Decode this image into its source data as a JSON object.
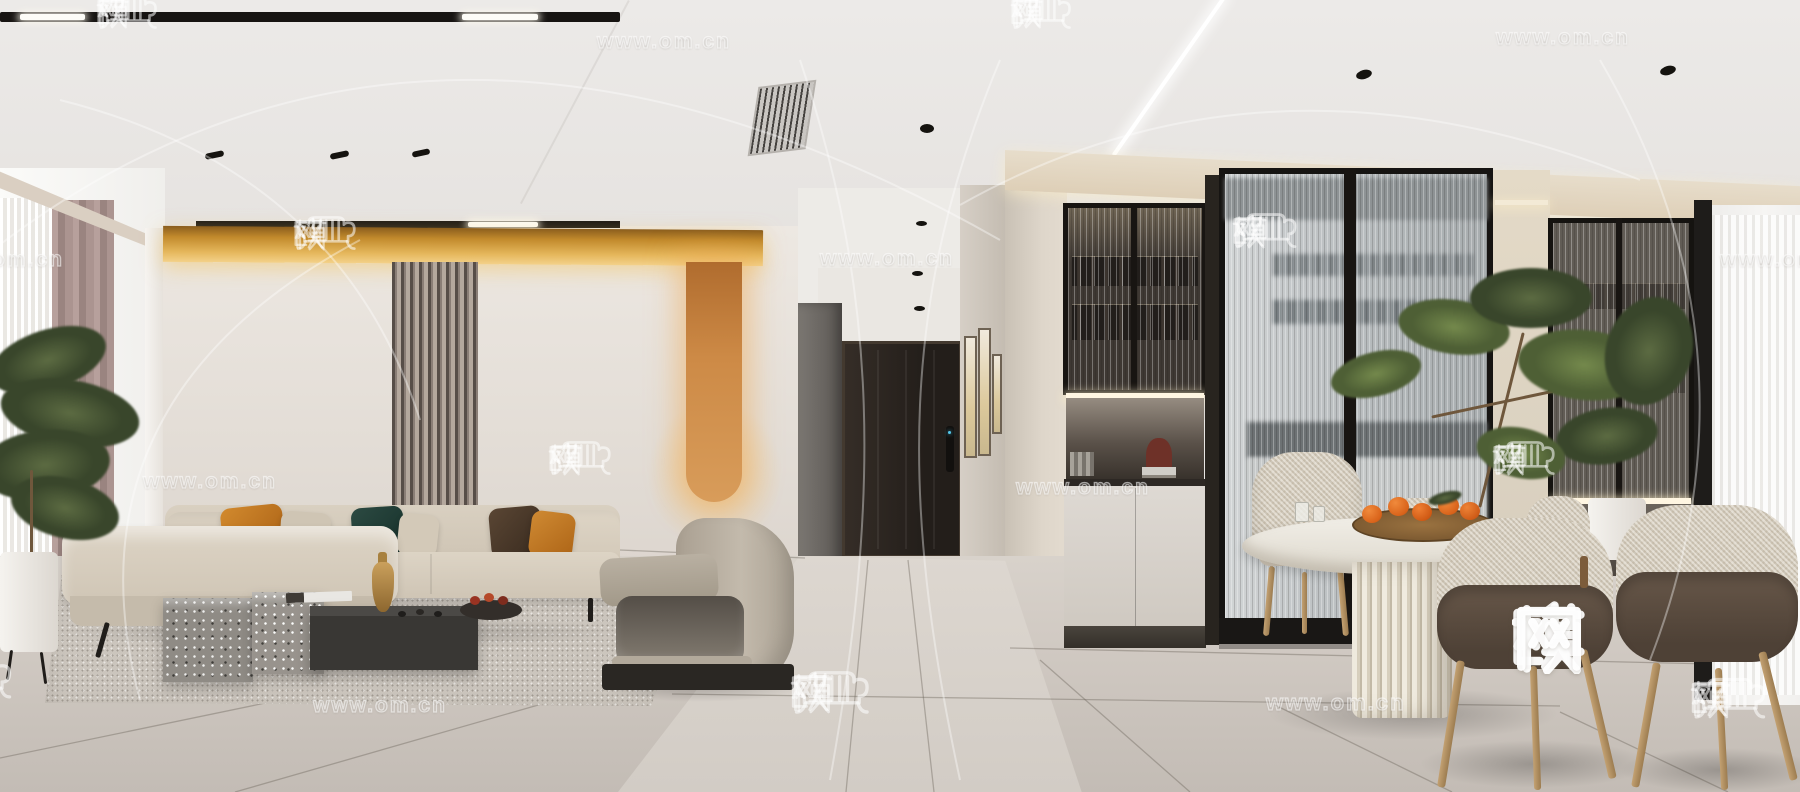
{
  "meta": {
    "site_brand": "欧模网",
    "site_url": "www.om.cn",
    "image_type": "interior-render"
  },
  "watermark": {
    "brand_text": "欧模网",
    "url_text": "www.om.cn",
    "large_badge": {
      "text": "欧模网",
      "x": 1512,
      "y": 600,
      "char_size": 74
    },
    "tiles": [
      {
        "type": "logo",
        "x": 96,
        "y": 12,
        "size": 34
      },
      {
        "type": "url",
        "x": 597,
        "y": 30,
        "size": 21
      },
      {
        "type": "logo",
        "x": 1010,
        "y": 12,
        "size": 34
      },
      {
        "type": "url",
        "x": 1496,
        "y": 26,
        "size": 21
      },
      {
        "type": "url",
        "x": -70,
        "y": 248,
        "size": 21
      },
      {
        "type": "logo",
        "x": 293,
        "y": 233,
        "size": 35
      },
      {
        "type": "url",
        "x": 820,
        "y": 247,
        "size": 21
      },
      {
        "type": "logo",
        "x": 1232,
        "y": 231,
        "size": 36
      },
      {
        "type": "url",
        "x": 1720,
        "y": 248,
        "size": 21
      },
      {
        "type": "url",
        "x": 143,
        "y": 470,
        "size": 21
      },
      {
        "type": "logo",
        "x": 548,
        "y": 458,
        "size": 35
      },
      {
        "type": "url",
        "x": 1016,
        "y": 476,
        "size": 21
      },
      {
        "type": "logo",
        "x": 1492,
        "y": 458,
        "size": 35
      },
      {
        "type": "logo",
        "x": -64,
        "y": 678,
        "size": 42
      },
      {
        "type": "url",
        "x": 313,
        "y": 694,
        "size": 21
      },
      {
        "type": "logo",
        "x": 790,
        "y": 692,
        "size": 44
      },
      {
        "type": "url",
        "x": 1266,
        "y": 690,
        "size": 22
      },
      {
        "type": "logo",
        "x": 1690,
        "y": 698,
        "size": 42
      }
    ]
  },
  "palette": {
    "gold_cove": "#e5b75c",
    "orange_stripe": "#cd8a46",
    "sofa_beige": "#d3c9ba",
    "pillow_orange": "#c07520",
    "pillow_teal": "#243d37",
    "terrazzo_grey": "#8f8b85",
    "floor_tile": "#cdc6bf",
    "curtain_mauve": "#ab9490",
    "door_dark": "#2b2520",
    "persimmon": "#d9631a",
    "frame_black": "#181512"
  }
}
